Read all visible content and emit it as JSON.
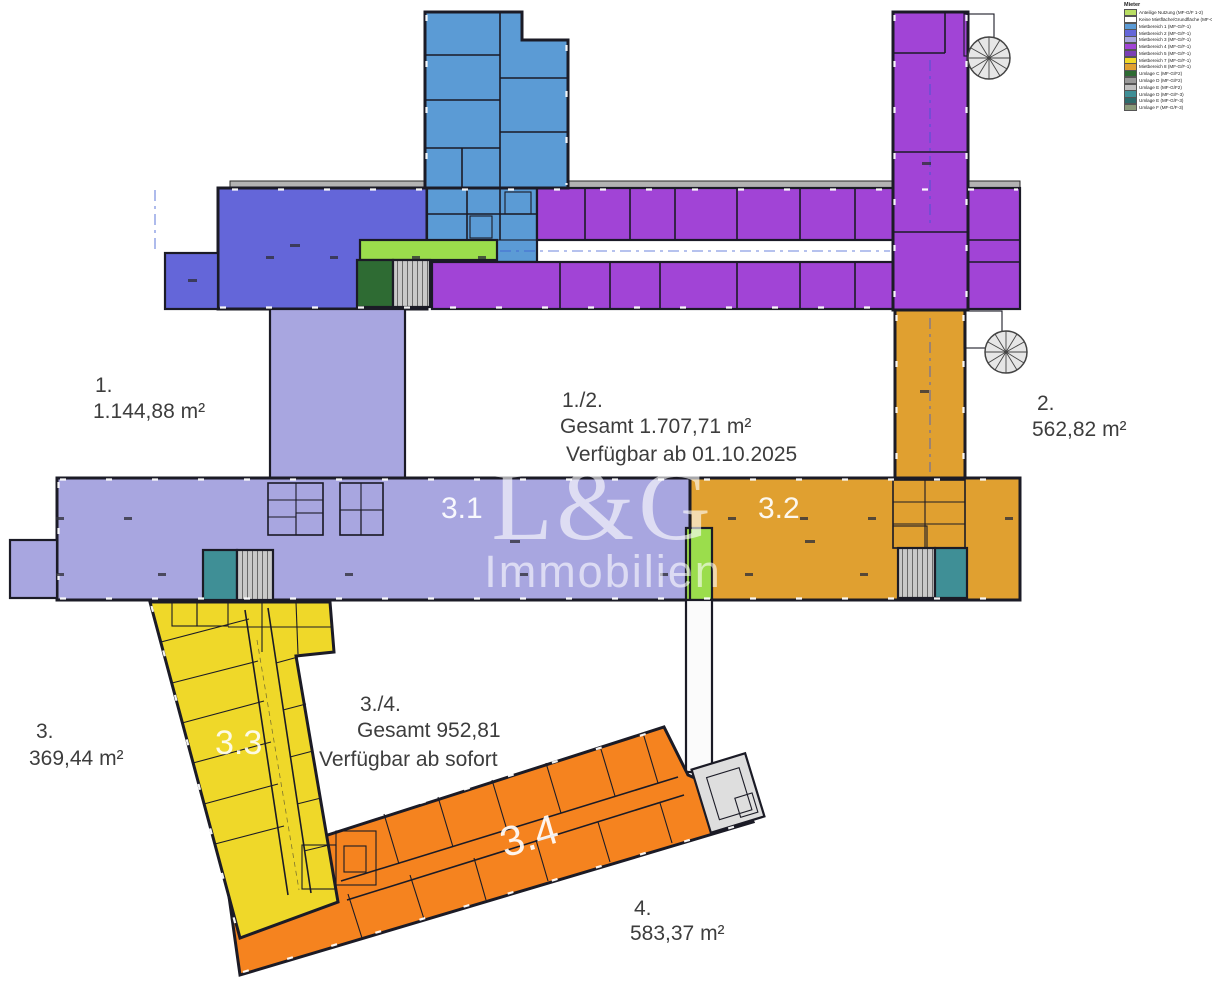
{
  "legend": {
    "title": "Mieter",
    "items": [
      {
        "label": "Anteilige Nutzung (MF-G/F 1-2)",
        "color": "#b9de63"
      },
      {
        "label": "Keine Mietfläche/Grundfläche (MF-G/F-0)",
        "color": "#ffffff"
      },
      {
        "label": "Mietbereich 1 (MF-G/F-1)",
        "color": "#5b9bd5"
      },
      {
        "label": "Mietbereich 2 (MF-G/F-1)",
        "color": "#6466d9"
      },
      {
        "label": "Mietbereich 3 (MF-G/F-1)",
        "color": "#a8a6e0"
      },
      {
        "label": "Mietbereich 4 (MF-G/F-1)",
        "color": "#a144d6"
      },
      {
        "label": "Mietbereich 5 (MF-G/F-1)",
        "color": "#7a3fb5"
      },
      {
        "label": "Mietbereich 7 (MF-G/F-1)",
        "color": "#efd829"
      },
      {
        "label": "Mietbereich 8 (MF-G/F-1)",
        "color": "#e0a030"
      },
      {
        "label": "Umlage C (MF-G/F2)",
        "color": "#2e6b33"
      },
      {
        "label": "Umlage D (MF-G/F2)",
        "color": "#9a9a9a"
      },
      {
        "label": "Umlage E (MF-G/F2)",
        "color": "#c0c0c0"
      },
      {
        "label": "Umlage D (MF-G/F-3)",
        "color": "#3f8f96"
      },
      {
        "label": "Umlage E (MF-G/F-3)",
        "color": "#2e6b6b"
      },
      {
        "label": "Umlage F (MF-G/F-3)",
        "color": "#8a9a7a"
      }
    ]
  },
  "areas": {
    "area1": {
      "id": "1.",
      "size": "1.144,88 m²"
    },
    "area12": {
      "id": "1./2.",
      "total": "Gesamt 1.707,71 m²",
      "availability": "Verfügbar ab 01.10.2025"
    },
    "area2": {
      "id": "2.",
      "size": "562,82 m²"
    },
    "area3": {
      "id": "3.",
      "size": "369,44 m²"
    },
    "area34": {
      "id": "3./4.",
      "total": "Gesamt 952,81",
      "availability": "Verfügbar ab sofort"
    },
    "area4": {
      "id": "4.",
      "size": "583,37 m²"
    }
  },
  "sections": {
    "s31": "3.1",
    "s32": "3.2",
    "s33": "3.3",
    "s34": "3.4"
  },
  "watermark": {
    "line1": "L&G",
    "line2": "Immobilien"
  },
  "colors": {
    "blue": "#5b9bd5",
    "indigo": "#6466d9",
    "lavender": "#a8a6e0",
    "purple": "#a144d6",
    "yellow": "#efd829",
    "amber": "#e0a030",
    "orange": "#f5831f",
    "green": "#9bdd4c",
    "dgreen": "#2e6b33",
    "olive": "#5f7a42",
    "teal": "#3f8f96",
    "stair": "#bcbcbc",
    "lgray": "#dedede",
    "wall": "#1b1b26"
  }
}
